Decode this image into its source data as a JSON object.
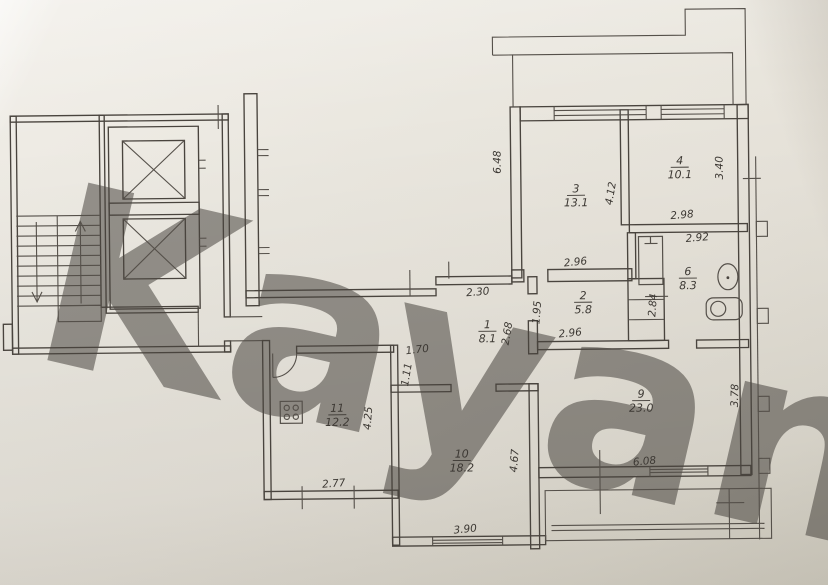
{
  "document": {
    "kind": "apartment-floor-plan-photo"
  },
  "watermark": {
    "text": "Kayan",
    "color": "#eba9b1",
    "opacity": 0.5
  },
  "palette": {
    "paper": "#e8e4db",
    "line": "#49443e",
    "label": "#3c3833"
  },
  "rooms": [
    {
      "number": "1",
      "area": "8.1",
      "x": 487,
      "y": 332
    },
    {
      "number": "2",
      "area": "5.8",
      "x": 583,
      "y": 304
    },
    {
      "number": "3",
      "area": "13.1",
      "x": 577,
      "y": 197
    },
    {
      "number": "4",
      "area": "10.1",
      "x": 681,
      "y": 170
    },
    {
      "number": "6",
      "area": "8.3",
      "x": 688,
      "y": 281
    },
    {
      "number": "9",
      "area": "23.0",
      "x": 640,
      "y": 403
    },
    {
      "number": "10",
      "area": "18.2",
      "x": 460,
      "y": 461
    },
    {
      "number": "11",
      "area": "12.2",
      "x": 336,
      "y": 414
    }
  ],
  "dimensions": [
    {
      "value": "6.48",
      "x": 502,
      "y": 163,
      "rot": -90
    },
    {
      "value": "4.12",
      "x": 615,
      "y": 196,
      "rot": -80
    },
    {
      "value": "3.40",
      "x": 724,
      "y": 171,
      "rot": -90
    },
    {
      "value": "2.98",
      "x": 683,
      "y": 221,
      "rot": -4
    },
    {
      "value": "2.92",
      "x": 698,
      "y": 244,
      "rot": -4
    },
    {
      "value": "2.96",
      "x": 576,
      "y": 267,
      "rot": -5
    },
    {
      "value": "2.96",
      "x": 570,
      "y": 338,
      "rot": -5
    },
    {
      "value": "1.95",
      "x": 540,
      "y": 314,
      "rot": -85
    },
    {
      "value": "2.68",
      "x": 510,
      "y": 335,
      "rot": -80
    },
    {
      "value": "2.30",
      "x": 478,
      "y": 296,
      "rot": -4
    },
    {
      "value": "2.84",
      "x": 656,
      "y": 308,
      "rot": -85
    },
    {
      "value": "1.70",
      "x": 417,
      "y": 353,
      "rot": -6
    },
    {
      "value": "1.11",
      "x": 409,
      "y": 375,
      "rot": -80
    },
    {
      "value": "4.25",
      "x": 370,
      "y": 418,
      "rot": -85
    },
    {
      "value": "2.77",
      "x": 332,
      "y": 486,
      "rot": -4
    },
    {
      "value": "3.90",
      "x": 463,
      "y": 533,
      "rot": -5
    },
    {
      "value": "4.67",
      "x": 516,
      "y": 462,
      "rot": -85
    },
    {
      "value": "6.08",
      "x": 643,
      "y": 467,
      "rot": -5
    },
    {
      "value": "3.78",
      "x": 737,
      "y": 399,
      "rot": -88
    }
  ]
}
